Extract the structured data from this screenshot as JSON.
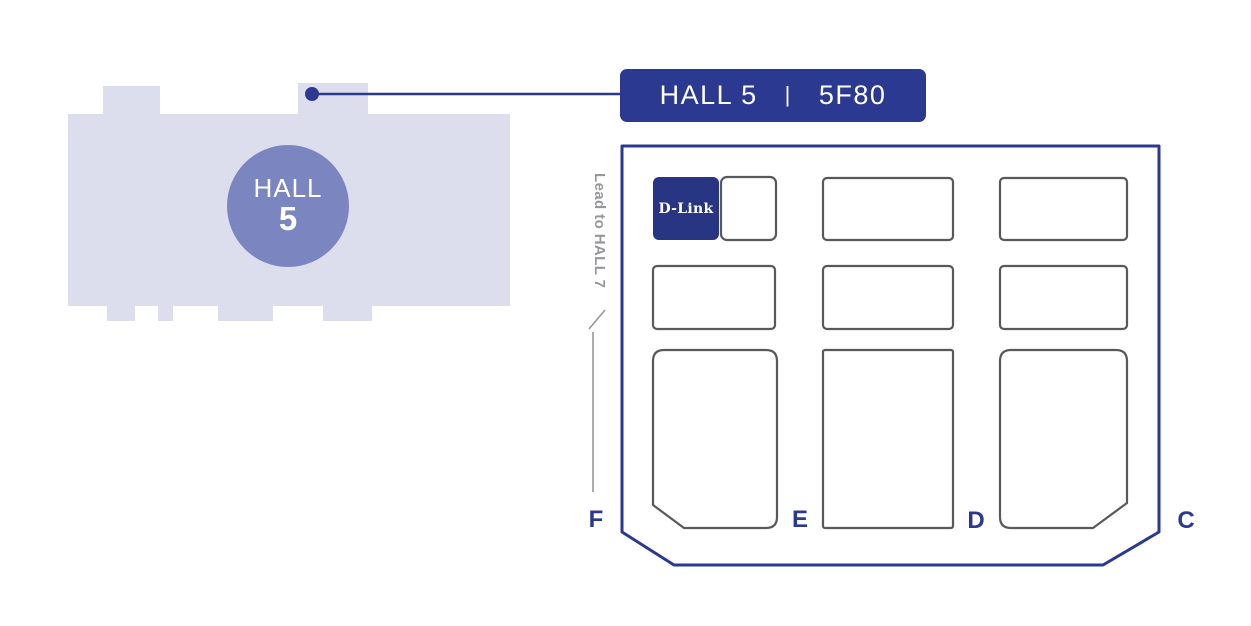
{
  "colors": {
    "brand_blue": "#2B3990",
    "dlink_booth_blue": "#273583",
    "building_fill": "#DCDEED",
    "circle_fill": "#7B86C1",
    "booth_outline_gray": "#58595B",
    "direction_gray": "#96979B",
    "text_white": "#FFFFFF"
  },
  "building": {
    "hall_word": "HALL",
    "hall_number": "5"
  },
  "callout": {
    "hall_text": "HALL 5",
    "separator": "|",
    "booth_text": "5F80"
  },
  "floorplan": {
    "direction_label": "Lead to HALL 7",
    "highlight_booth": {
      "label": "D-Link"
    },
    "aisles": [
      {
        "label": "F"
      },
      {
        "label": "E"
      },
      {
        "label": "D"
      },
      {
        "label": "C"
      }
    ]
  }
}
